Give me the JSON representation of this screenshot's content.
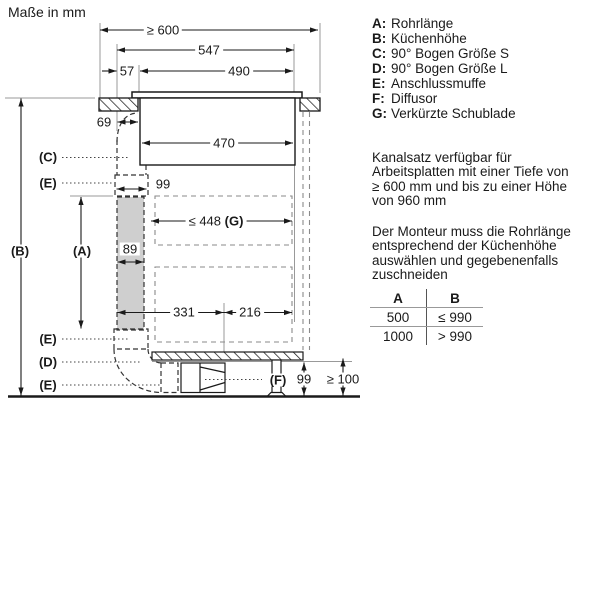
{
  "title": "Maße in mm",
  "diagram": {
    "dimensions": {
      "worktop_depth": "≥ 600",
      "hob_width": "547",
      "offset_left": "57",
      "cutout_width": "490",
      "duct_offset": "69",
      "plenum_width": "470",
      "muffe_width": "99",
      "pipe_width": "89",
      "drawer_width": "≤ 448",
      "drawer_width_key": "(G)",
      "dist_left": "331",
      "dist_right": "216",
      "plinth_duct_height": "99",
      "plinth_min_height": "≥ 100"
    },
    "labels": {
      "a": "(A)",
      "b": "(B)",
      "c": "(C)",
      "d": "(D)",
      "e_top": "(E)",
      "e_mid": "(E)",
      "e_bot": "(E)",
      "f": "(F)"
    }
  },
  "legend": {
    "items": [
      {
        "key": "A:",
        "label": "Rohrlänge"
      },
      {
        "key": "B:",
        "label": "Küchenhöhe"
      },
      {
        "key": "C:",
        "label": "90° Bogen Größe S"
      },
      {
        "key": "D:",
        "label": "90° Bogen Größe L"
      },
      {
        "key": "E:",
        "label": "Anschlussmuffe"
      },
      {
        "key": "F:",
        "label": "Diffusor"
      },
      {
        "key": "G:",
        "label": "Verkürzte Schublade"
      }
    ]
  },
  "notes": {
    "para1_lines": [
      "Kanalsatz verfügbar für",
      "Arbeitsplatten mit einer Tiefe von",
      "≥ 600 mm und bis zu einer Höhe",
      "von 960 mm"
    ],
    "para2_lines": [
      "Der Monteur muss die Rohrlänge",
      "entsprechend der Küchenhöhe",
      "auswählen und gegebenenfalls",
      "zuschneiden"
    ]
  },
  "table": {
    "headers": [
      "A",
      "B"
    ],
    "rows": [
      [
        "500",
        "≤ 990"
      ],
      [
        "1000",
        "> 990"
      ]
    ]
  },
  "colors": {
    "line": "#1a1a1a",
    "reference": "#999999",
    "dash_dark": "#333333",
    "dash_gray": "#8a8a8a",
    "pipe_fill": "#cfcfcf"
  }
}
